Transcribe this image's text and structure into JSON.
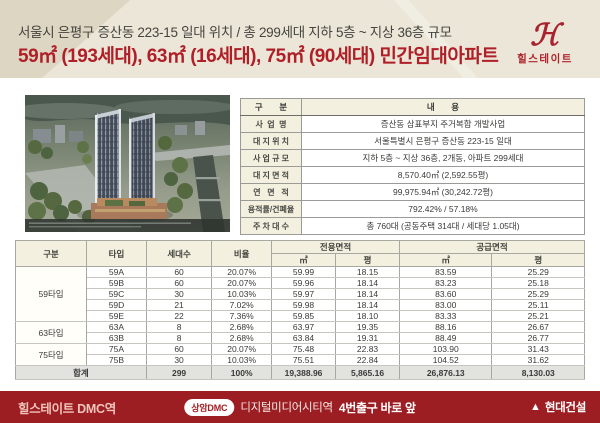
{
  "header": {
    "line1": "서울시 은평구 증산동 223-15 일대 위치 / 총 299세대 지하 5층 ~ 지상 36층 규모",
    "line2": "59㎡ (193세대), 63㎡ (16세대), 75㎡ (90세대) 민간임대아파트",
    "logo": {
      "monogram": "ℋ",
      "name": "힐스테이트"
    }
  },
  "info_table": {
    "col_headers": [
      "구       분",
      "내       용"
    ],
    "rows": [
      [
        "사  업  명",
        "증산동 삼표부지 주거복합 개발사업"
      ],
      [
        "대 지 위 치",
        "서울특별시 은평구 증산동 223-15 일대"
      ],
      [
        "사 업 규 모",
        "지하 5층 ~ 지상 36층, 2개동, 아파트 299세대"
      ],
      [
        "대 지 면 적",
        "8,570.40㎡ (2,592.55평)"
      ],
      [
        "연   면   적",
        "99,975.94㎡ (30,242.72평)"
      ],
      [
        "용적률/건폐율",
        "792.42% / 57.18%"
      ],
      [
        "주 차 대 수",
        "총 760대 (공동주택 314대 / 세대당 1.05대)"
      ]
    ]
  },
  "unit_table": {
    "headers": {
      "group": "구분",
      "type": "타입",
      "households": "세대수",
      "ratio": "비율",
      "exclusive": "전용면적",
      "supply": "공급면적",
      "sqm": "㎡",
      "pyeong": "평"
    },
    "groups": [
      {
        "label": "59타입",
        "rows": [
          [
            "59A",
            "60",
            "20.07%",
            "59.99",
            "18.15",
            "83.59",
            "25.29"
          ],
          [
            "59B",
            "60",
            "20.07%",
            "59.96",
            "18.14",
            "83.23",
            "25.18"
          ],
          [
            "59C",
            "30",
            "10.03%",
            "59.97",
            "18.14",
            "83.60",
            "25.29"
          ],
          [
            "59D",
            "21",
            "7.02%",
            "59.98",
            "18.14",
            "83.00",
            "25.11"
          ],
          [
            "59E",
            "22",
            "7.36%",
            "59.85",
            "18.10",
            "83.33",
            "25.21"
          ]
        ]
      },
      {
        "label": "63타입",
        "rows": [
          [
            "63A",
            "8",
            "2.68%",
            "63.97",
            "19.35",
            "88.16",
            "26.67"
          ],
          [
            "63B",
            "8",
            "2.68%",
            "63.84",
            "19.31",
            "88.49",
            "26.77"
          ]
        ]
      },
      {
        "label": "75타입",
        "rows": [
          [
            "75A",
            "60",
            "20.07%",
            "75.48",
            "22.83",
            "103.90",
            "31.43"
          ],
          [
            "75B",
            "30",
            "10.03%",
            "75.51",
            "22.84",
            "104.52",
            "31.62"
          ]
        ]
      }
    ],
    "total": [
      "합계",
      "299",
      "100%",
      "19,388.96",
      "5,865.16",
      "26,876.13",
      "8,130.03"
    ]
  },
  "footer": {
    "left": "힐스테이트 DMC역",
    "station_badge": "상암DMC",
    "station_text": "디지털미디어시티역",
    "station_highlight": "4번출구 바로 앞",
    "builder": "현대건설"
  },
  "colors": {
    "brand_red": "#b01f27",
    "footer_red": "#9c1d22",
    "band_beige": "#ebe6d7",
    "table_header_cream": "#f3f0e0"
  }
}
